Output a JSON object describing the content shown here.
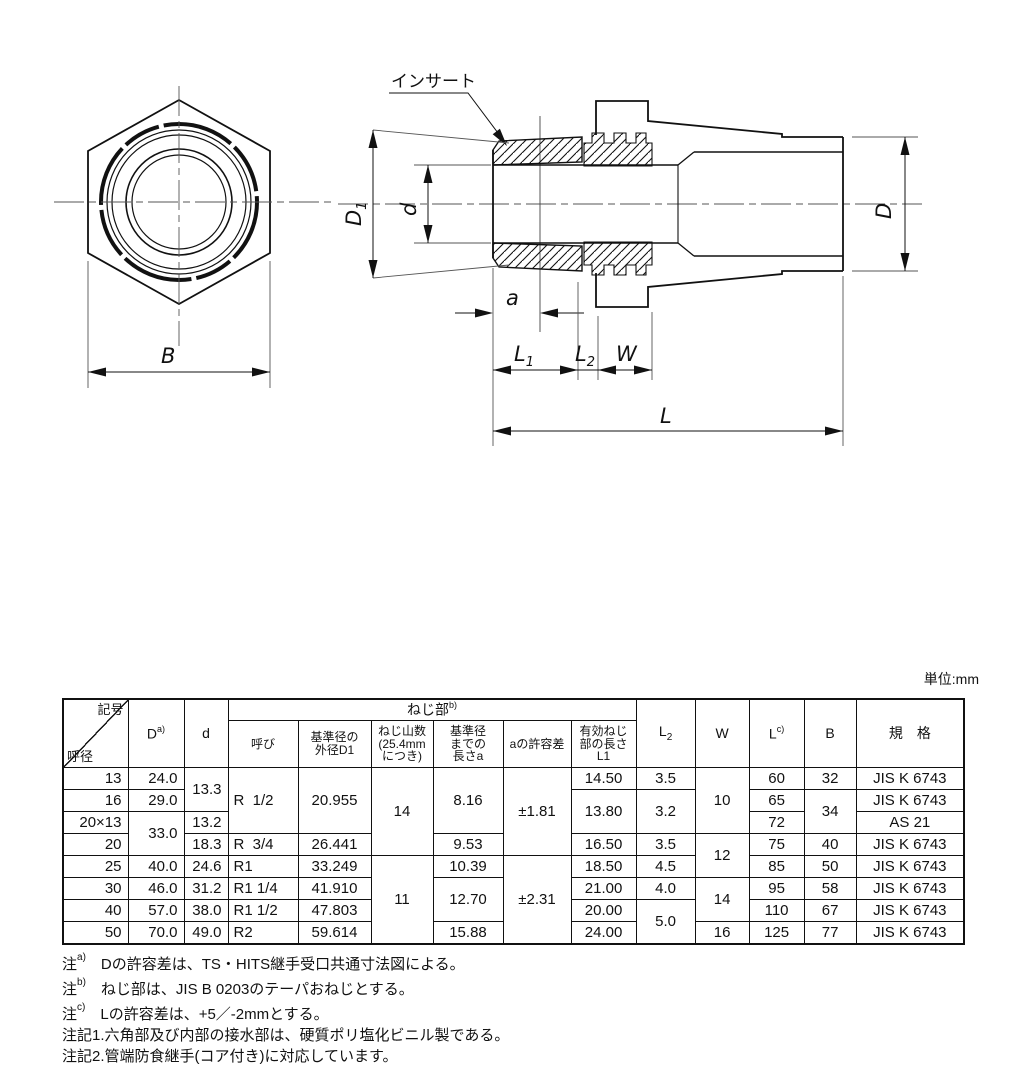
{
  "unit_label": "単位:mm",
  "drawing": {
    "insert_label": "インサート",
    "dims": {
      "B": "B",
      "D": "D",
      "d": "d",
      "a": "a",
      "W": "W",
      "L": "L",
      "D1": {
        "main": "D",
        "sub": "1"
      },
      "L1": {
        "main": "L",
        "sub": "1"
      },
      "L2": {
        "main": "L",
        "sub": "2"
      }
    }
  },
  "table": {
    "header": {
      "corner_top": "記号",
      "corner_bottom": "呼径",
      "D": "D",
      "D_sup": "a)",
      "d": "d",
      "thread_group": "ねじ部",
      "thread_group_sup": "b)",
      "thread_cols": [
        "呼び",
        "基準径の\n外径D1",
        "ねじ山数\n(25.4mm\nにつき)",
        "基準径\nまでの\n長さa",
        "aの許容差",
        "有効ねじ\n部の長さ\nL1"
      ],
      "L2_main": "L",
      "L2_sub": "2",
      "W": "W",
      "L": "L",
      "L_sup": "c)",
      "B": "B",
      "standard": "規　格"
    },
    "rows": [
      [
        {
          "t": "13",
          "al": "r"
        },
        {
          "t": "24.0",
          "al": "r"
        },
        {
          "t": "13.3",
          "rs": 2,
          "al": "r"
        },
        {
          "t": "R  1/2",
          "rs": 3,
          "al": "l"
        },
        {
          "t": "20.955",
          "rs": 3
        },
        {
          "t": "14",
          "rs": 4
        },
        {
          "t": "8.16",
          "rs": 3
        },
        {
          "t": "±1.81",
          "rs": 4
        },
        {
          "t": "14.50"
        },
        {
          "t": "3.5"
        },
        {
          "t": "10",
          "rs": 3
        },
        {
          "t": "60"
        },
        {
          "t": "32"
        },
        {
          "t": "JIS K 6743"
        }
      ],
      [
        {
          "t": "16",
          "al": "r"
        },
        {
          "t": "29.0",
          "al": "r"
        },
        {
          "t": "13.80",
          "rs": 2
        },
        {
          "t": "3.2",
          "rs": 2
        },
        {
          "t": "65"
        },
        {
          "t": "34",
          "rs": 2
        },
        {
          "t": "JIS K 6743"
        }
      ],
      [
        {
          "t": "20×13",
          "al": "r"
        },
        {
          "t": "33.0",
          "rs": 2,
          "al": "r"
        },
        {
          "t": "13.2",
          "al": "r"
        },
        {
          "t": "72"
        },
        {
          "t": "AS 21"
        }
      ],
      [
        {
          "t": "20",
          "al": "r"
        },
        {
          "t": "18.3",
          "al": "r"
        },
        {
          "t": "R  3/4",
          "al": "l"
        },
        {
          "t": "26.441"
        },
        {
          "t": "9.53"
        },
        {
          "t": "16.50"
        },
        {
          "t": "3.5"
        },
        {
          "t": "12",
          "rs": 2
        },
        {
          "t": "75"
        },
        {
          "t": "40"
        },
        {
          "t": "JIS K 6743"
        }
      ],
      [
        {
          "t": "25",
          "al": "r"
        },
        {
          "t": "40.0",
          "al": "r"
        },
        {
          "t": "24.6",
          "al": "r"
        },
        {
          "t": "R1",
          "al": "l"
        },
        {
          "t": "33.249"
        },
        {
          "t": "11",
          "rs": 4
        },
        {
          "t": "10.39"
        },
        {
          "t": "±2.31",
          "rs": 4
        },
        {
          "t": "18.50"
        },
        {
          "t": "4.5"
        },
        {
          "t": "85"
        },
        {
          "t": "50"
        },
        {
          "t": "JIS K 6743"
        }
      ],
      [
        {
          "t": "30",
          "al": "r"
        },
        {
          "t": "46.0",
          "al": "r"
        },
        {
          "t": "31.2",
          "al": "r"
        },
        {
          "t": "R1 1/4",
          "al": "l"
        },
        {
          "t": "41.910"
        },
        {
          "t": "12.70",
          "rs": 2
        },
        {
          "t": "21.00"
        },
        {
          "t": "4.0"
        },
        {
          "t": "14",
          "rs": 2
        },
        {
          "t": "95"
        },
        {
          "t": "58"
        },
        {
          "t": "JIS K 6743"
        }
      ],
      [
        {
          "t": "40",
          "al": "r"
        },
        {
          "t": "57.0",
          "al": "r"
        },
        {
          "t": "38.0",
          "al": "r"
        },
        {
          "t": "R1 1/2",
          "al": "l"
        },
        {
          "t": "47.803"
        },
        {
          "t": "20.00"
        },
        {
          "t": "5.0",
          "rs": 2
        },
        {
          "t": "110"
        },
        {
          "t": "67"
        },
        {
          "t": "JIS K 6743"
        }
      ],
      [
        {
          "t": "50",
          "al": "r"
        },
        {
          "t": "70.0",
          "al": "r"
        },
        {
          "t": "49.0",
          "al": "r"
        },
        {
          "t": "R2",
          "al": "l"
        },
        {
          "t": "59.614"
        },
        {
          "t": "15.88"
        },
        {
          "t": "24.00"
        },
        {
          "t": "16"
        },
        {
          "t": "125"
        },
        {
          "t": "77"
        },
        {
          "t": "JIS K 6743"
        }
      ]
    ]
  },
  "notes": [
    {
      "prefix": "注",
      "sup": "a)",
      "text": "Dの許容差は、TS・HITS継手受口共通寸法図による。"
    },
    {
      "prefix": "注",
      "sup": "b)",
      "text": "ねじ部は、JIS B 0203のテーパおねじとする。"
    },
    {
      "prefix": "注",
      "sup": "c)",
      "text": "Lの許容差は、+5／-2mmとする。"
    },
    {
      "prefix": "注記1.",
      "sup": "",
      "text": "六角部及び内部の接水部は、硬質ポリ塩化ビニル製である。"
    },
    {
      "prefix": "注記2.",
      "sup": "",
      "text": "管端防食継手(コア付き)に対応しています。"
    }
  ]
}
